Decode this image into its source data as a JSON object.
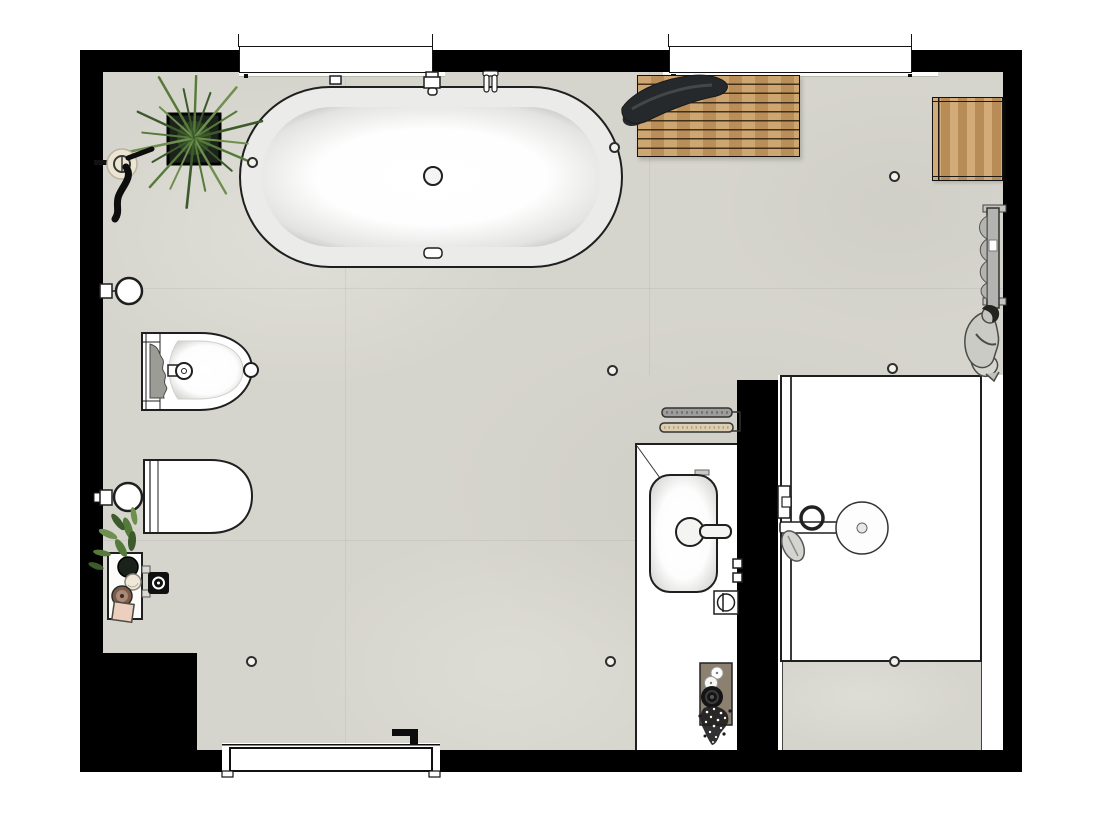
{
  "meta": {
    "title": "Bathroom floor plan",
    "view": "top-down 2D plan render",
    "visible_text": "none"
  },
  "colors": {
    "wall": "#000000",
    "floor": "#d6d5cd",
    "floor_seam": "rgba(0,0,0,0.05)",
    "outline": "#1f1f1f",
    "porcelain": "#ffffff",
    "wood": "#c79a62",
    "towel_black": "#26292b",
    "towel_gray": "#9d9d9b",
    "towel_beige": "#dbceb1",
    "metal": "#b3b3af",
    "plant_dark": "#3c5a2c",
    "plant_mid": "#567a3a",
    "plant_light": "#6f8f4e",
    "pot": "#1b211b",
    "tray_taupe": "#8c8071",
    "dish_cream": "#efe7d8",
    "dish_brown": "#7c5b4a",
    "soap_pink": "#eccfbc",
    "bowl_black": "#141414",
    "sketch_fill": "#cbcbc6",
    "sketch_line": "#4b4b47"
  },
  "rooms": [
    {
      "name": "bathroom",
      "shape": "rectangular with partition-walled walk-in shower"
    }
  ],
  "windows": {
    "count": 2,
    "location": "top wall"
  },
  "doors": {
    "count": 1,
    "location": "bottom wall",
    "handle_side": "right"
  },
  "lights": {
    "count": 8,
    "type": "recessed ceiling spots"
  },
  "fixtures": [
    {
      "name": "bathtub",
      "label": "Freestanding oval bathtub with overflow and drain"
    },
    {
      "name": "tub-filler",
      "label": "Wall-mounted tub filler"
    },
    {
      "name": "hand-shower",
      "label": "Hand shower in wall holder"
    },
    {
      "name": "duckboard-mat",
      "label": "Wooden slatted bath mat"
    },
    {
      "name": "bath-towel",
      "label": "Black towel on mat"
    },
    {
      "name": "stool",
      "label": "Wooden stool / side table"
    },
    {
      "name": "towel-radiator",
      "label": "Towel radiator with towel"
    },
    {
      "name": "person",
      "label": "Seated person sketch"
    },
    {
      "name": "plant-large",
      "label": "Large spiky potted plant"
    },
    {
      "name": "wall-hook",
      "label": "Wall hook with hanging towel"
    },
    {
      "name": "paper-holder-upper",
      "label": "Wall-mounted toilet roll holder"
    },
    {
      "name": "bidet",
      "label": "Bidet with mixer"
    },
    {
      "name": "toilet",
      "label": "Wall-hung toilet"
    },
    {
      "name": "paper-holder-lower",
      "label": "Wall-mounted toilet roll holder"
    },
    {
      "name": "plant-shelf",
      "label": "Low shelf with plant, dishes and soap"
    },
    {
      "name": "wall-control",
      "label": "Wall-mounted control / flush plate"
    },
    {
      "name": "towel-rail",
      "label": "Towel rail with grey and beige towels"
    },
    {
      "name": "vanity",
      "label": "Vanity counter"
    },
    {
      "name": "sink",
      "label": "Countertop basin with mixer tap"
    },
    {
      "name": "drain-valve",
      "label": "Floor valve box"
    },
    {
      "name": "partition",
      "label": "Shower partition wall"
    },
    {
      "name": "shower-tray",
      "label": "Walk-in shower tray with glass line"
    },
    {
      "name": "shower-head",
      "label": "Wall-arm rain shower head"
    },
    {
      "name": "shower-valve",
      "label": "Shower valve with knob"
    },
    {
      "name": "decor-tray",
      "label": "Tray with candles, black bowl and flowers"
    },
    {
      "name": "entry-door",
      "label": "Entry door with black handle"
    }
  ]
}
